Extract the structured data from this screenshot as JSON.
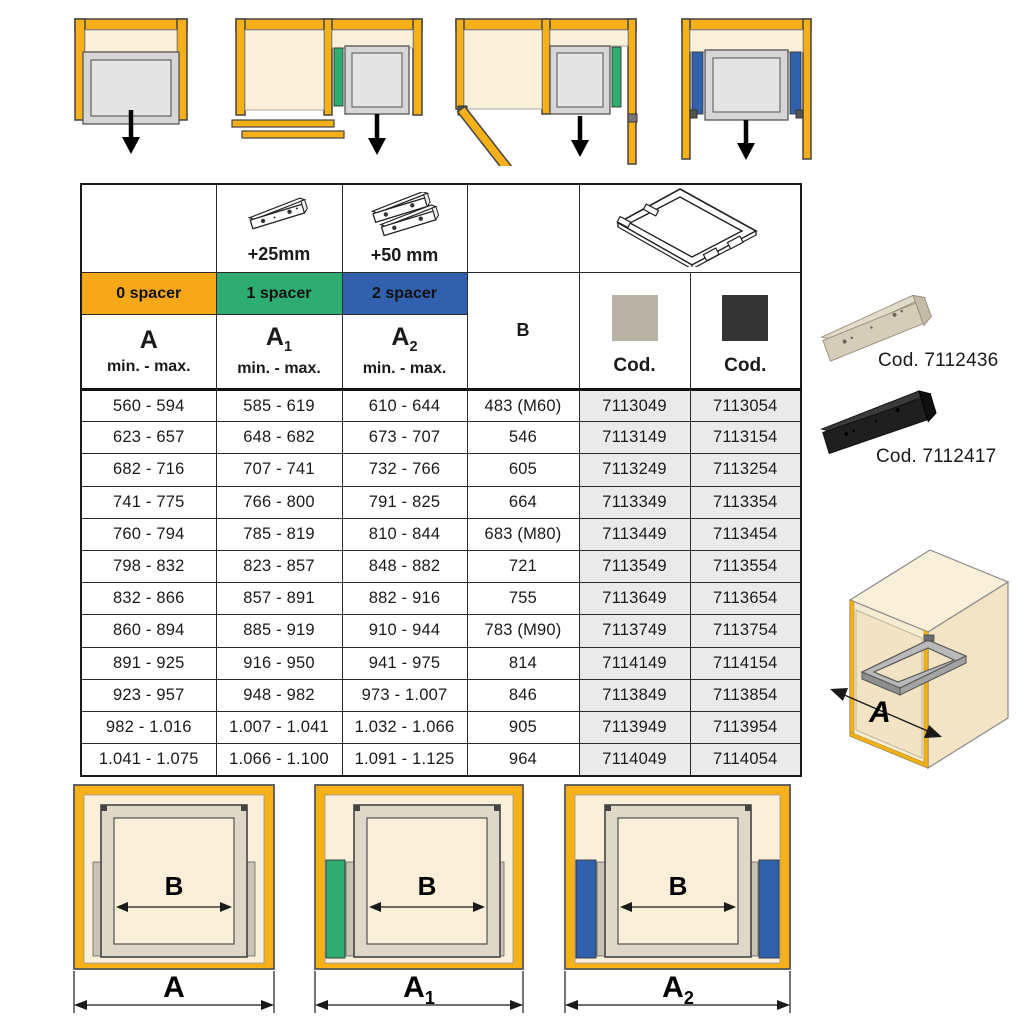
{
  "colors": {
    "orange": "#F6A818",
    "green": "#2EAC72",
    "blue": "#3160AC",
    "yellow": "#F6B119",
    "cream": "#FAEFD8",
    "cream_dark": "#F2E4C4",
    "swatch_grey": "#B7B4A5",
    "swatch_dark": "#343434",
    "cod_cell_bg": "#EAEAEA",
    "drawer_grey": "#D6D6D6",
    "drawer_light": "#E4E4E4"
  },
  "table": {
    "header": {
      "plus25": "+25mm",
      "plus50": "+50 mm",
      "spacers": [
        "0 spacer",
        "1 spacer",
        "2 spacer"
      ],
      "a_base": "A",
      "a1_base": "A",
      "a1_sub": "1",
      "a2_base": "A",
      "a2_sub": "2",
      "minmax": "min. - max.",
      "b": "B",
      "cod1": "Cod.",
      "cod2": "Cod."
    },
    "rows": [
      [
        "560 - 594",
        "585 - 619",
        "610 - 644",
        "483 (M60)",
        "7113049",
        "7113054"
      ],
      [
        "623 - 657",
        "648 - 682",
        "673 - 707",
        "546",
        "7113149",
        "7113154"
      ],
      [
        "682 - 716",
        "707 - 741",
        "732 - 766",
        "605",
        "7113249",
        "7113254"
      ],
      [
        "741 - 775",
        "766 - 800",
        "791 - 825",
        "664",
        "7113349",
        "7113354"
      ],
      [
        "760 - 794",
        "785 - 819",
        "810 - 844",
        "683 (M80)",
        "7113449",
        "7113454"
      ],
      [
        "798 - 832",
        "823 - 857",
        "848 - 882",
        "721",
        "7113549",
        "7113554"
      ],
      [
        "832 - 866",
        "857 - 891",
        "882 - 916",
        "755",
        "7113649",
        "7113654"
      ],
      [
        "860 - 894",
        "885 - 919",
        "910 - 944",
        "783 (M90)",
        "7113749",
        "7113754"
      ],
      [
        "891 - 925",
        "916 - 950",
        "941 - 975",
        "814",
        "7114149",
        "7114154"
      ],
      [
        "923 - 957",
        "948 - 982",
        "973 - 1.007",
        "846",
        "7113849",
        "7113854"
      ],
      [
        "982 - 1.016",
        "1.007 - 1.041",
        "1.032 - 1.066",
        "905",
        "7113949",
        "7113954"
      ],
      [
        "1.041 - 1.075",
        "1.066 - 1.100",
        "1.091 - 1.125",
        "964",
        "7114049",
        "7114054"
      ]
    ]
  },
  "side_products": {
    "item1_code": "Cod. 7112436",
    "item2_code": "Cod. 7112417"
  },
  "bottom_diagrams": {
    "b_label": "B",
    "a_label": "A",
    "a1_base": "A",
    "a1_sub": "1",
    "a2_base": "A",
    "a2_sub": "2"
  },
  "cabinet_3d": {
    "a_label": "A"
  }
}
